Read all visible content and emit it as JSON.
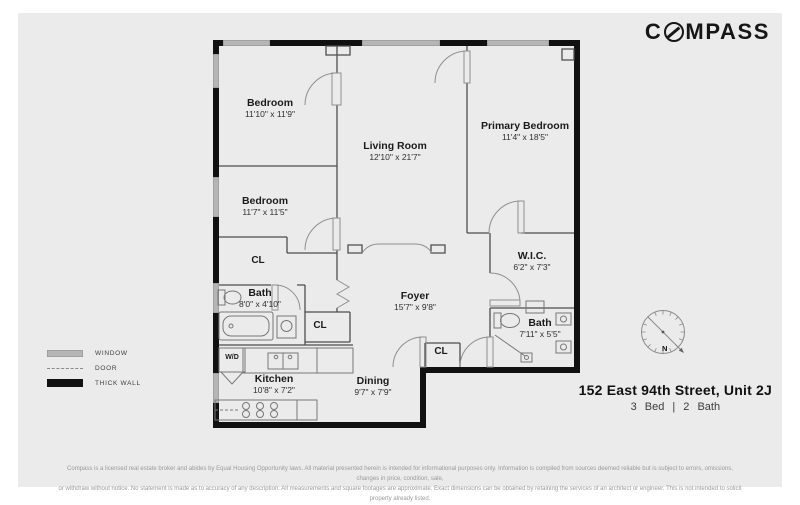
{
  "brand": {
    "name": "COMPASS",
    "logo_first": "C",
    "logo_rest": "MPASS"
  },
  "plan": {
    "rooms": [
      {
        "name": "Bedroom",
        "dims": "11'10\" x 11'9\""
      },
      {
        "name": "Bedroom",
        "dims": "11'7\" x 11'5\""
      },
      {
        "name": "Living Room",
        "dims": "12'10\" x 21'7\""
      },
      {
        "name": "Primary Bedroom",
        "dims": "11'4\" x 18'5\""
      },
      {
        "name": "W.I.C.",
        "dims": "6'2\" x 7'3\""
      },
      {
        "name": "Bath",
        "dims": "8'0\" x 4'10\""
      },
      {
        "name": "Foyer",
        "dims": "15'7\" x 9'8\""
      },
      {
        "name": "Bath",
        "dims": "7'11\" x 5'5\""
      },
      {
        "name": "Kitchen",
        "dims": "10'8\" x 7'2\""
      },
      {
        "name": "Dining",
        "dims": "9'7\" x 7'9\""
      }
    ],
    "closets": [
      {
        "label": "CL"
      },
      {
        "label": "CL"
      },
      {
        "label": "CL"
      },
      {
        "label": "W/D"
      }
    ]
  },
  "legend": {
    "items": [
      {
        "label": "WINDOW"
      },
      {
        "label": "DOOR"
      },
      {
        "label": "THICK WALL"
      }
    ]
  },
  "compass_rose": {
    "north_label": "N"
  },
  "listing": {
    "address": "152 East 94th Street, Unit 2J",
    "specs": "3 Bed | 2 Bath"
  },
  "disclaimer": {
    "line1": "Compass is a licensed real estate broker and abides by Equal Housing Opportunity laws. All material presented herein is intended for informational purposes only. Information is compiled from sources deemed reliable but is subject to errors, omissions, changes in price, condition, sale,",
    "line2": "or withdraw without notice. No statement is made as to accuracy of any description. All measurements and square footages are approximate. Exact dimensions can be obtained by retaining the services of an architect or engineer. This is not intended to solicit property already listed."
  },
  "colors": {
    "sheet_background": "#ebebeb",
    "thick_wall": "#111111",
    "window": "#b5b5b5",
    "interior_line": "#4e4e4e",
    "text": "#1b1b1b"
  }
}
